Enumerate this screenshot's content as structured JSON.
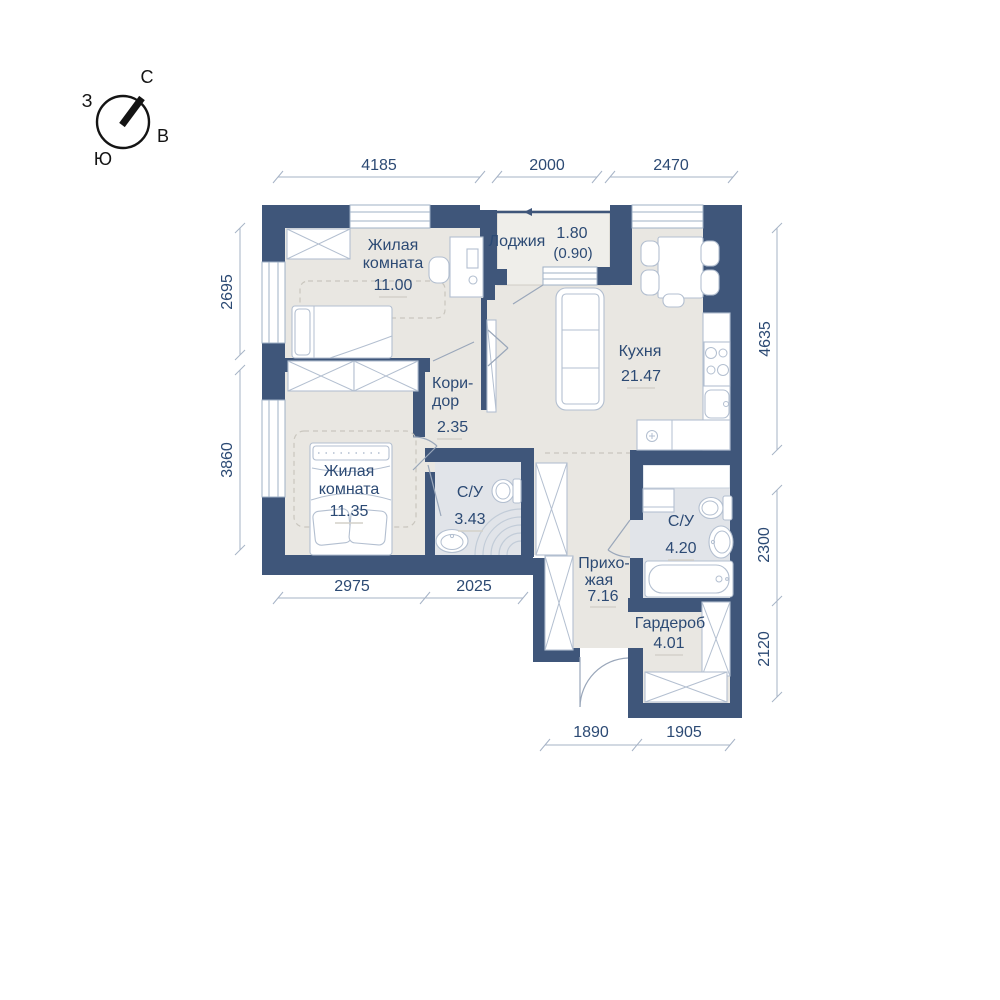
{
  "compass": {
    "north": "С",
    "east": "В",
    "south": "Ю",
    "west": "З"
  },
  "rooms": {
    "bedroom1": {
      "name1": "Жилая",
      "name2": "комната",
      "area": "11.00"
    },
    "bedroom2": {
      "name1": "Жилая",
      "name2": "комната",
      "area": "11.35"
    },
    "loggia": {
      "name": "Лоджия",
      "area": "1.80",
      "area_reduced": "(0.90)"
    },
    "kitchen": {
      "name": "Кухня",
      "area": "21.47"
    },
    "corridor": {
      "name1": "Кори-",
      "name2": "дор",
      "area": "2.35"
    },
    "bath1": {
      "name": "С/У",
      "area": "3.43"
    },
    "bath2": {
      "name": "С/У",
      "area": "4.20"
    },
    "hallway": {
      "name1": "Прихо-",
      "name2": "жая",
      "area": "7.16"
    },
    "wardrobe": {
      "name": "Гардероб",
      "area": "4.01"
    }
  },
  "dimensions": {
    "top": [
      "4185",
      "2000",
      "2470"
    ],
    "left": [
      "2695",
      "3860"
    ],
    "right": [
      "4635",
      "2300",
      "2120"
    ],
    "inner_bottom": [
      "2975",
      "2025"
    ],
    "bottom": [
      "1890",
      "1905"
    ]
  },
  "colors": {
    "wall": "#3f567a",
    "floor": "#e9e7e2",
    "bath_floor": "#e1e4e9",
    "text": "#2c4a74",
    "dim_line": "#a6b3c6"
  }
}
